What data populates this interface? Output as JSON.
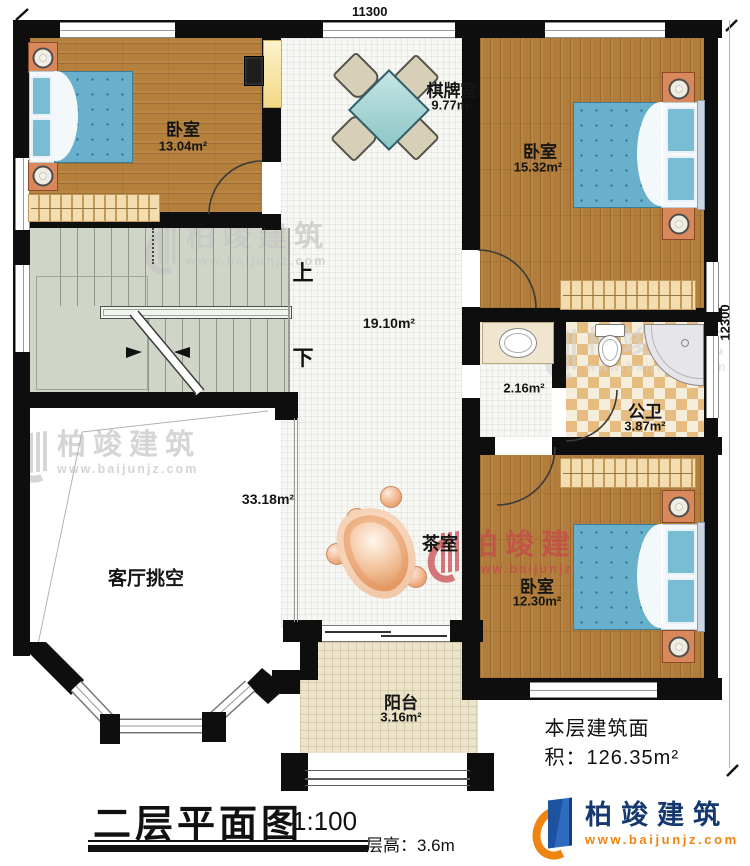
{
  "plan": {
    "dimension_top": "11300",
    "dimension_right": "12300",
    "rooms": {
      "bedroom_tl": {
        "name": "卧室",
        "area": "13.04m²"
      },
      "chess_room": {
        "name": "棋牌室",
        "area": "9.77m²"
      },
      "bedroom_tr": {
        "name": "卧室",
        "area": "15.32m²"
      },
      "hall": {
        "area": "19.10m²"
      },
      "vestibule": {
        "area": "2.16m²"
      },
      "bathroom": {
        "name": "公卫",
        "area": "3.87m²"
      },
      "living_void": {
        "name": "客厅挑空",
        "area": "33.18m²"
      },
      "tea_room": {
        "name": "茶室"
      },
      "bedroom_br": {
        "name": "卧室",
        "area": "12.30m²"
      },
      "balcony": {
        "name": "阳台",
        "area": "3.16m²"
      }
    },
    "stairs": {
      "up_label": "上",
      "down_label": "下"
    }
  },
  "title_block": {
    "floor_area_note": "本层建筑面积：126.35m²",
    "title": "二层平面图",
    "scale": "1:100",
    "floor_height": "层高：3.6m"
  },
  "brand": {
    "name": "柏竣建筑",
    "website": "www.baijunjz.com",
    "name_color": "#14386f",
    "website_color": "#ef8410"
  },
  "watermark": {
    "text": "柏竣建筑",
    "url": "www.baijunjz.com"
  },
  "colors": {
    "wall": "#0e0e0e",
    "wood_floor": "#b5803c",
    "stair_floor": "#cfd6c7",
    "bath_tile": "#e6bc80",
    "balcony_tile": "#ebe4ca",
    "bed": "#68b0cb",
    "watermark_gray": "#c7c7c7",
    "watermark_red": "#c8464b"
  }
}
